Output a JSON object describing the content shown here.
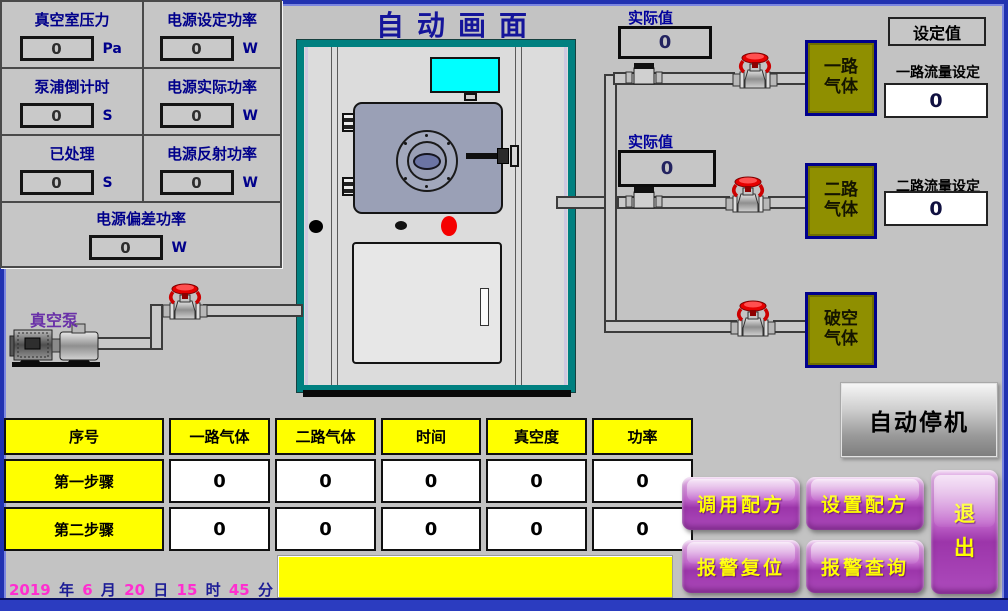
{
  "title": "自动画面",
  "metrics": {
    "vacuum_pressure": {
      "label": "真空室压力",
      "value": "0",
      "unit": "Pa"
    },
    "power_set": {
      "label": "电源设定功率",
      "value": "0",
      "unit": "W"
    },
    "pump_countdown": {
      "label": "泵浦倒计时",
      "value": "0",
      "unit": "S"
    },
    "power_actual": {
      "label": "电源实际功率",
      "value": "0",
      "unit": "W"
    },
    "processed": {
      "label": "已处理",
      "value": "0",
      "unit": "S"
    },
    "power_reflected": {
      "label": "电源反射功率",
      "value": "0",
      "unit": "W"
    },
    "power_deviation": {
      "label": "电源偏差功率",
      "value": "0",
      "unit": "W"
    }
  },
  "pump_label": "真空泵",
  "gas_lines": [
    {
      "actual_label": "实际值",
      "actual_value": "0",
      "name_line1": "一路",
      "name_line2": "气体",
      "set_label": "一路流量设定",
      "set_value": "0"
    },
    {
      "actual_label": "实际值",
      "actual_value": "0",
      "name_line1": "二路",
      "name_line2": "气体",
      "set_label": "二路流量设定",
      "set_value": "0"
    },
    {
      "name_line1": "破空",
      "name_line2": "气体"
    }
  ],
  "set_panel_title": "设定值",
  "auto_stop_label": "自动停机",
  "table": {
    "headers": [
      "序号",
      "一路气体",
      "二路气体",
      "时间",
      "真空度",
      "功率"
    ],
    "rows": [
      {
        "label": "第一步骤",
        "values": [
          "0",
          "0",
          "0",
          "0",
          "0"
        ]
      },
      {
        "label": "第二步骤",
        "values": [
          "0",
          "0",
          "0",
          "0",
          "0"
        ]
      }
    ]
  },
  "buttons": {
    "recipe_load": "调用配方",
    "recipe_set": "设置配方",
    "alarm_reset": "报警复位",
    "alarm_query": "报警查询",
    "exit_char1": "退",
    "exit_char2": "出"
  },
  "datetime": {
    "year": "2019",
    "year_unit": "年",
    "month": "6",
    "month_unit": "月",
    "day": "20",
    "day_unit": "日",
    "hour": "15",
    "hour_unit": "时",
    "minute": "45",
    "minute_unit": "分"
  },
  "alarm_message": "",
  "colors": {
    "background": "#c3c3c3",
    "frame_blue": "#2132b0",
    "panel_text_blue": "#00008b",
    "yellow": "#ffff00",
    "olive_gas_box": "#8f8f00",
    "machine_teal": "#008080",
    "button_purple": "#9c35aa",
    "button_text_yellow": "#ffff00",
    "indicator_red": "#f50000",
    "screen_cyan": "#00ffff",
    "datetime_pink": "#ff2ed0"
  }
}
